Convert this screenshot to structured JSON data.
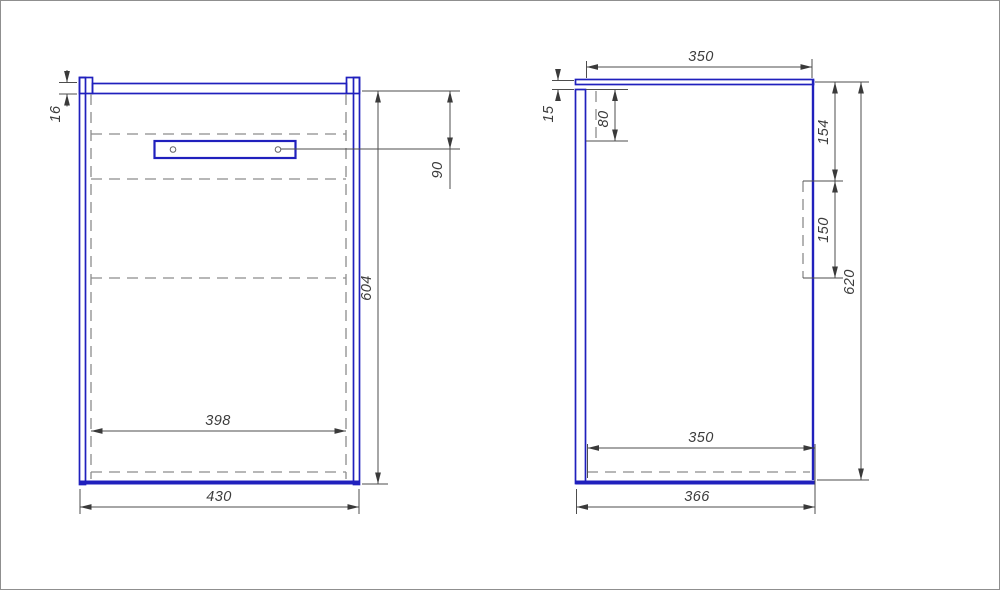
{
  "colors": {
    "outline": "#2020bd",
    "hidden": "#8c8c8c",
    "dimension": "#4d4d4d"
  },
  "front_view": {
    "dimensions": {
      "rail_thickness": "16",
      "rail_offset_top": "90",
      "side_height": "604",
      "inner_width": "398",
      "overall_width": "430"
    }
  },
  "side_view": {
    "dimensions": {
      "top_depth": "350",
      "back_top_gap": "15",
      "hanger_height": "80",
      "bracket_top_offset": "154",
      "bracket_height": "150",
      "overall_height": "620",
      "bottom_inner_depth": "350",
      "overall_depth": "366"
    }
  }
}
